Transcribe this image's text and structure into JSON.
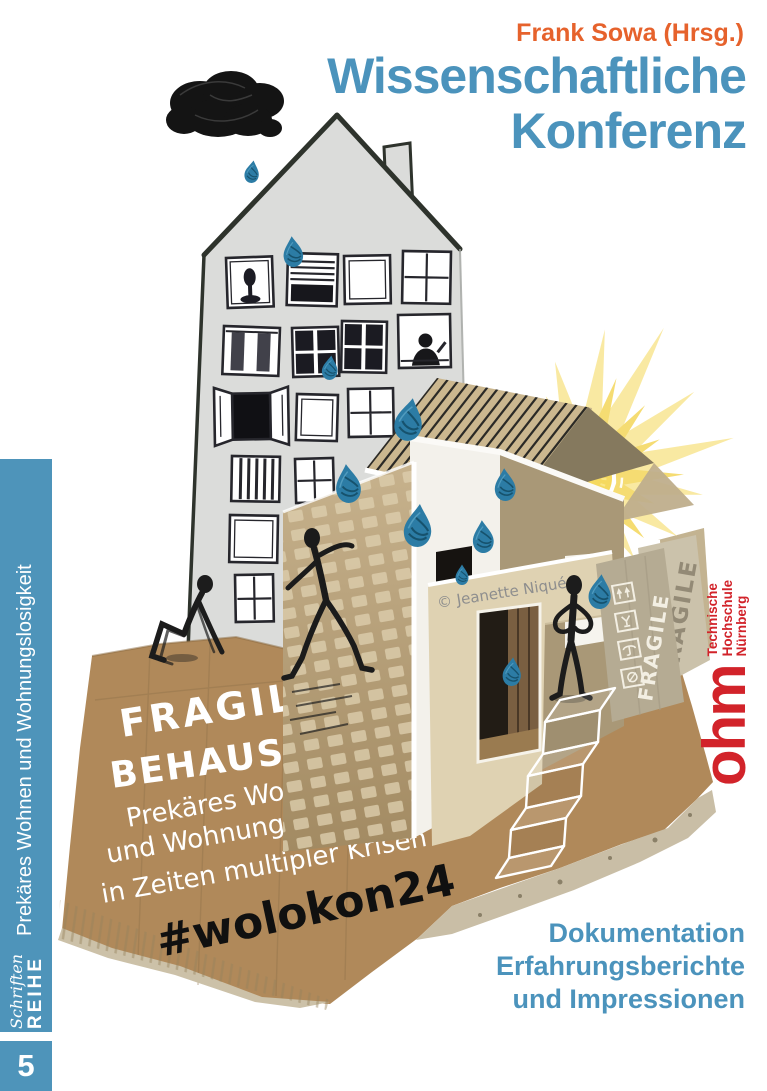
{
  "cover": {
    "editor": "Frank Sowa (Hrsg.)",
    "title_line1": "Wissenschaftliche",
    "title_line2": "Konferenz",
    "subtitle_line1": "Dokumentation",
    "subtitle_line2": "Erfahrungsberichte",
    "subtitle_line3": "und Impressionen"
  },
  "sidebar": {
    "topic": "Prekäres Wohnen und Wohnungslosigkeit",
    "series_name": "Schriften",
    "series_word": "REIHE",
    "volume": "5"
  },
  "logo": {
    "wordmark": "ohm",
    "institution_line1": "Technische",
    "institution_line2": "Hochschule",
    "institution_line3": "Nürnberg"
  },
  "illustration": {
    "headline_line1": "FRAGILE",
    "headline_line2": "BEHAUSUNGEN",
    "sub_line1": "Prekäres Wohnen",
    "sub_line2": "und Wohnungslosigkeit",
    "sub_line3": "in Zeiten multipler Krisen",
    "hashtag": "#wolokon24",
    "credit": "© Jeanette Niqué",
    "box_label_front": "FRAGILE",
    "box_label_back": "FRAGILE"
  },
  "colors": {
    "accent_blue": "#4B93BC",
    "accent_orange": "#E6622C",
    "logo_red": "#D2232A",
    "cardboard": "#B0895A",
    "drop_blue": "#2C7CA5",
    "sun_yellow": "#F5D95F"
  }
}
